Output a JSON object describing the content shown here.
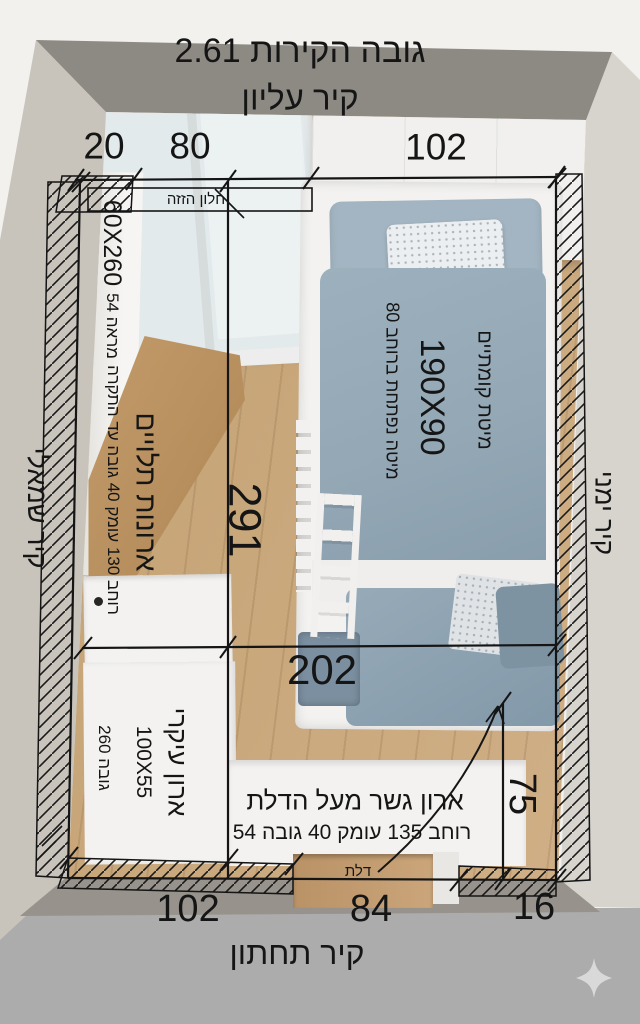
{
  "header": {
    "wall_height_label": "גובה הקירות 2.61",
    "top_wall_label": "קיר עליון"
  },
  "wall_labels": {
    "left": "קיר שמאלי",
    "right": "קיר ימני",
    "bottom": "קיר תחתון"
  },
  "top_dimensions": {
    "seg1": "20",
    "seg2": "80",
    "seg3": "102"
  },
  "bottom_dimensions": {
    "seg1": "102",
    "seg2": "84",
    "seg3": "16"
  },
  "interior_dimensions": {
    "room_length": "291",
    "room_width": "202",
    "door_clearance": "75"
  },
  "window": {
    "label": "חלון הזזה"
  },
  "mirror": {
    "size": "60X260",
    "label": "מראה 54"
  },
  "hanging_cabinets": {
    "label": "ארונות תלויים",
    "details": "רוחב 130 עומק 40 גובה עד התקרה"
  },
  "bunk_bed": {
    "label": "מיטת קומתיים",
    "size": "190X90",
    "pullout": "מיטה נפתחת ברוחב 80"
  },
  "main_closet": {
    "label": "ארון עיקרי",
    "size": "100X55",
    "height": "גובה 260"
  },
  "bridge_cabinet": {
    "label": "ארון גשר מעל הדלת",
    "details": "רוחב 135 עומק 40 גובה 54"
  },
  "door": {
    "label": "דלת"
  },
  "icons": {
    "sparkle": "sparkle-watermark"
  },
  "colors": {
    "bg-top": "#f2f1ee",
    "bg-bottom": "#acacac",
    "wall-band": "#8d8a84",
    "outer-left": "#c8c4bc",
    "outer-right": "#d7d4ce",
    "outer-bottom": "#97938c",
    "floor": "#c8a77b",
    "desk": "#b68d5c",
    "white-furn": "#f3f2f0",
    "bedding": "#93a7b5",
    "bedding-dark": "#8299a9",
    "ann": "#151515",
    "sparkle": "#d9d9d9"
  }
}
